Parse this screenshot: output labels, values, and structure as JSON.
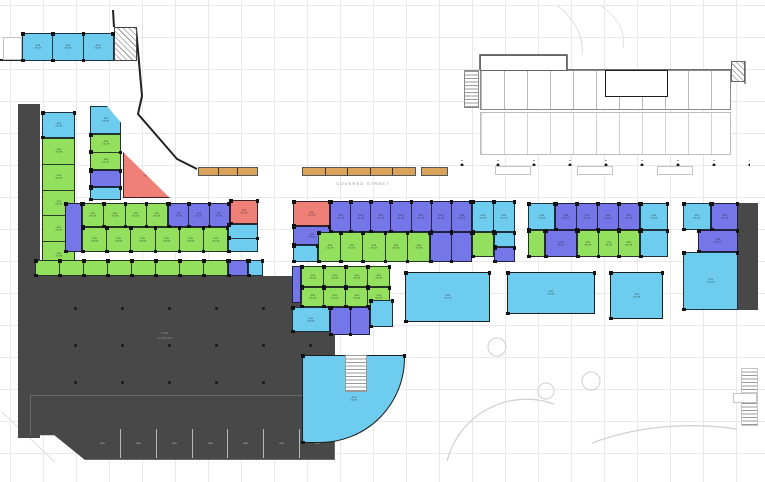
{
  "meta": {
    "width": 765,
    "height": 482,
    "drawing_type": "architectural ground-floor retail/parking plan"
  },
  "palette": {
    "cyan": "#6ecdee",
    "green": "#92e05e",
    "purple": "#7577e8",
    "red": "#ef8077",
    "orange": "#d9a35b",
    "dark": "#484848",
    "wall": "#1c1c1c",
    "faint": "#cfcfcf",
    "grid": "#e9e9e9"
  },
  "labels": {
    "covered_street": "COVERED  STREET",
    "illegible_unit_line1": "xxx",
    "illegible_unit_line2": "xx.xx",
    "parking_line1": "xxx",
    "parking_line2": "x,xxx xx",
    "storage_unit": "xxx",
    "ramp_box": "xxx"
  },
  "floorplan": {
    "rects": [
      {
        "name": "topleft-cyan-row",
        "x": 22,
        "y": 33,
        "w": 92,
        "h": 28,
        "fill": "cyan",
        "cols": 3,
        "label": true
      },
      {
        "name": "topleft-stair-hatch",
        "x": 114,
        "y": 27,
        "w": 23,
        "h": 34,
        "fill": "#ffffff",
        "hatch": "d",
        "stroke": "#444"
      },
      {
        "name": "topleft-small-room",
        "x": 3,
        "y": 37,
        "w": 19,
        "h": 23,
        "fill": "#ffffff",
        "stroke": "#c3c3c3"
      },
      {
        "name": "left-dark-strip",
        "x": 18,
        "y": 104,
        "w": 22,
        "h": 334,
        "fill": "dark"
      },
      {
        "name": "left-colA-cyan",
        "x": 42,
        "y": 112,
        "w": 33,
        "h": 26,
        "fill": "cyan",
        "label": true
      },
      {
        "name": "left-colA-green",
        "x": 42,
        "y": 138,
        "w": 33,
        "h": 130,
        "fill": "green",
        "rows": 5,
        "label": true
      },
      {
        "name": "left-colB-cyan-top",
        "x": 90,
        "y": 106,
        "w": 31,
        "h": 28,
        "fill": "cyan",
        "clip": "polygon(0 0,55% 0,100% 60%,100% 100%,0 100%)",
        "label": true
      },
      {
        "name": "left-colB-green",
        "x": 90,
        "y": 134,
        "w": 31,
        "h": 36,
        "fill": "green",
        "rows": 2,
        "label": true
      },
      {
        "name": "left-colB-purple",
        "x": 90,
        "y": 170,
        "w": 31,
        "h": 17,
        "fill": "purple"
      },
      {
        "name": "left-colB-cyan-bottom",
        "x": 90,
        "y": 187,
        "w": 31,
        "h": 13,
        "fill": "cyan"
      },
      {
        "name": "red-triangle-unit",
        "x": 123,
        "y": 152,
        "w": 47,
        "h": 46,
        "fill": "red",
        "clip": "polygon(0 0,100% 100%,0 100%)",
        "label": true
      },
      {
        "name": "dblrow-purple-end",
        "x": 65,
        "y": 203,
        "w": 17,
        "h": 49,
        "fill": "purple"
      },
      {
        "name": "dblrow-r1-green",
        "x": 82,
        "y": 203,
        "w": 86,
        "h": 24,
        "fill": "green",
        "cols": 4,
        "label": true
      },
      {
        "name": "dblrow-r1-purple",
        "x": 168,
        "y": 203,
        "w": 62,
        "h": 24,
        "fill": "purple",
        "cols": 3,
        "label": true
      },
      {
        "name": "dblrow-r1-red",
        "x": 230,
        "y": 200,
        "w": 28,
        "h": 24,
        "fill": "red",
        "label": true
      },
      {
        "name": "dblrow-r2-green",
        "x": 82,
        "y": 227,
        "w": 146,
        "h": 25,
        "fill": "green",
        "cols": 6,
        "label": true
      },
      {
        "name": "dblrow-r2-cyan",
        "x": 228,
        "y": 224,
        "w": 30,
        "h": 28,
        "fill": "cyan",
        "rows": 2
      },
      {
        "name": "arcade-strip-green",
        "x": 35,
        "y": 260,
        "w": 193,
        "h": 16,
        "fill": "green",
        "cols": 8
      },
      {
        "name": "arcade-strip-purple",
        "x": 228,
        "y": 260,
        "w": 20,
        "h": 16,
        "fill": "purple"
      },
      {
        "name": "arcade-strip-cyan",
        "x": 248,
        "y": 260,
        "w": 15,
        "h": 16,
        "fill": "cyan"
      },
      {
        "name": "parking-garage-main",
        "x": 30,
        "y": 276,
        "w": 305,
        "h": 119,
        "fill": "dark",
        "pattern": "dots",
        "ds": "47px 37px",
        "dc": "rgba(15,15,15,.8)"
      },
      {
        "name": "parking-garage-lower",
        "x": 30,
        "y": 395,
        "w": 305,
        "h": 65,
        "fill": "dark",
        "clip": "polygon(0 0,100% 0,100% 100%,18% 100%,8% 62%,0 62%)",
        "stroke": "#6a6a6a"
      },
      {
        "name": "storage-units-row",
        "x": 85,
        "y": 429,
        "w": 250,
        "h": 29,
        "fill": "none",
        "cols": 7,
        "div": "#b9b9b9",
        "label": "light"
      },
      {
        "name": "center-red-corner",
        "x": 293,
        "y": 201,
        "w": 37,
        "h": 25,
        "fill": "red",
        "label": true
      },
      {
        "name": "center-r1-purple",
        "x": 330,
        "y": 201,
        "w": 142,
        "h": 31,
        "fill": "purple",
        "cols": 7,
        "label": true
      },
      {
        "name": "center-r1-cyan",
        "x": 472,
        "y": 201,
        "w": 43,
        "h": 31,
        "fill": "cyan",
        "cols": 2,
        "label": true
      },
      {
        "name": "center-purple-under-red",
        "x": 293,
        "y": 226,
        "w": 37,
        "h": 19,
        "fill": "purple",
        "label": true
      },
      {
        "name": "center-cyan-small",
        "x": 293,
        "y": 245,
        "w": 25,
        "h": 17,
        "fill": "cyan"
      },
      {
        "name": "center-r2-green",
        "x": 318,
        "y": 232,
        "w": 112,
        "h": 30,
        "fill": "green",
        "cols": 5,
        "label": true
      },
      {
        "name": "center-r2-purple",
        "x": 430,
        "y": 232,
        "w": 42,
        "h": 30,
        "fill": "purple",
        "cols": 2
      },
      {
        "name": "center-r2-green-end",
        "x": 472,
        "y": 232,
        "w": 22,
        "h": 25,
        "fill": "green"
      },
      {
        "name": "center-r2-cyan-end",
        "x": 494,
        "y": 232,
        "w": 21,
        "h": 15,
        "fill": "cyan"
      },
      {
        "name": "center-r2-purple-end",
        "x": 494,
        "y": 247,
        "w": 21,
        "h": 15,
        "fill": "purple"
      },
      {
        "name": "south-purple-sliver",
        "x": 292,
        "y": 266,
        "w": 9,
        "h": 37,
        "fill": "purple"
      },
      {
        "name": "south-green-r1",
        "x": 301,
        "y": 266,
        "w": 89,
        "h": 21,
        "fill": "green",
        "cols": 4,
        "label": true
      },
      {
        "name": "south-green-r2",
        "x": 301,
        "y": 287,
        "w": 89,
        "h": 20,
        "fill": "green",
        "cols": 4,
        "label": true
      },
      {
        "name": "south-cyan",
        "x": 292,
        "y": 307,
        "w": 38,
        "h": 25,
        "fill": "cyan",
        "label": true
      },
      {
        "name": "south-purple",
        "x": 330,
        "y": 307,
        "w": 40,
        "h": 28,
        "fill": "purple",
        "cols": 2
      },
      {
        "name": "south-cyan2",
        "x": 370,
        "y": 300,
        "w": 23,
        "h": 27,
        "fill": "cyan"
      },
      {
        "name": "hall-west",
        "x": 405,
        "y": 272,
        "w": 85,
        "h": 50,
        "fill": "cyan",
        "label": true,
        "wall": true
      },
      {
        "name": "hall-mid",
        "x": 507,
        "y": 272,
        "w": 88,
        "h": 42,
        "fill": "cyan",
        "label": true,
        "wall": true
      },
      {
        "name": "hall-east",
        "x": 610,
        "y": 272,
        "w": 53,
        "h": 47,
        "fill": "cyan",
        "label": true,
        "wall": true
      },
      {
        "name": "curved-corner-unit",
        "x": 302,
        "y": 355,
        "w": 103,
        "h": 88,
        "fill": "cyan",
        "wall": true,
        "round": "0 0 85px 0",
        "label": true
      },
      {
        "name": "curved-unit-stair-notch",
        "x": 345,
        "y": 355,
        "w": 22,
        "h": 37,
        "fill": "#ffffff",
        "stroke": "#999",
        "hatch": "h"
      },
      {
        "name": "right-r1-cyan",
        "x": 528,
        "y": 203,
        "w": 27,
        "h": 27,
        "fill": "cyan",
        "label": true
      },
      {
        "name": "right-r1-purple",
        "x": 555,
        "y": 203,
        "w": 85,
        "h": 27,
        "fill": "purple",
        "cols": 4,
        "label": true
      },
      {
        "name": "right-r1-cyan2",
        "x": 640,
        "y": 203,
        "w": 28,
        "h": 27,
        "fill": "cyan",
        "label": true
      },
      {
        "name": "right-r2-green",
        "x": 528,
        "y": 230,
        "w": 17,
        "h": 27,
        "fill": "green"
      },
      {
        "name": "right-r2-purple",
        "x": 545,
        "y": 230,
        "w": 32,
        "h": 27,
        "fill": "purple",
        "label": true
      },
      {
        "name": "right-r2-green2",
        "x": 577,
        "y": 230,
        "w": 63,
        "h": 27,
        "fill": "green",
        "cols": 3,
        "label": true
      },
      {
        "name": "right-r2-cyan",
        "x": 640,
        "y": 230,
        "w": 28,
        "h": 27,
        "fill": "cyan"
      },
      {
        "name": "farright-cyan",
        "x": 683,
        "y": 203,
        "w": 28,
        "h": 27,
        "fill": "cyan",
        "label": true
      },
      {
        "name": "farright-purple",
        "x": 711,
        "y": 203,
        "w": 27,
        "h": 27,
        "fill": "purple",
        "label": true
      },
      {
        "name": "farright-purple2",
        "x": 698,
        "y": 230,
        "w": 40,
        "h": 22,
        "fill": "purple",
        "label": true
      },
      {
        "name": "farright-big-cyan",
        "x": 683,
        "y": 252,
        "w": 55,
        "h": 58,
        "fill": "cyan",
        "label": true
      },
      {
        "name": "farright-dark-strip",
        "x": 738,
        "y": 203,
        "w": 20,
        "h": 107,
        "fill": "dark"
      },
      {
        "name": "northeast-rooms-band1",
        "x": 480,
        "y": 70,
        "w": 251,
        "h": 40,
        "fill": "#ffffff",
        "stroke": "#8a8a8a",
        "pattern": "v",
        "vs": 23,
        "vc": "#b9b9b9"
      },
      {
        "name": "northeast-rooms-band2",
        "x": 480,
        "y": 112,
        "w": 251,
        "h": 43,
        "fill": "#ffffff",
        "stroke": "#bdbdbd",
        "pattern": "v",
        "vs": 23,
        "vc": "#d2d2d2"
      },
      {
        "name": "northeast-top-box",
        "x": 480,
        "y": 55,
        "w": 87,
        "h": 16,
        "fill": "#ffffff",
        "stroke": "#666"
      },
      {
        "name": "northeast-elevator-core",
        "x": 605,
        "y": 70,
        "w": 63,
        "h": 27,
        "fill": "#ffffff",
        "wall": true
      },
      {
        "name": "northeast-stair",
        "x": 464,
        "y": 70,
        "w": 15,
        "h": 38,
        "fill": "#ffffff",
        "hatch": "h",
        "stroke": "#8a8a8a"
      },
      {
        "name": "northeast-hatch-box",
        "x": 731,
        "y": 61,
        "w": 14,
        "h": 21,
        "fill": "#ffffff",
        "hatch": "d",
        "stroke": "#666"
      },
      {
        "name": "northeast-dot-row",
        "x": 458,
        "y": 160,
        "w": 292,
        "h": 6,
        "fill": "none",
        "pattern": "dots",
        "ds": "36px 6px",
        "dc": "#222"
      },
      {
        "name": "northeast-sign1",
        "x": 495,
        "y": 166,
        "w": 36,
        "h": 9,
        "fill": "#ffffff",
        "stroke": "#c3c3c3",
        "label": "light"
      },
      {
        "name": "northeast-sign2",
        "x": 577,
        "y": 166,
        "w": 36,
        "h": 9,
        "fill": "#ffffff",
        "stroke": "#c3c3c3",
        "label": "light"
      },
      {
        "name": "northeast-sign3",
        "x": 657,
        "y": 166,
        "w": 36,
        "h": 9,
        "fill": "#ffffff",
        "stroke": "#c3c3c3",
        "label": "light"
      },
      {
        "name": "awning-strip-1",
        "x": 198,
        "y": 167,
        "w": 60,
        "h": 9,
        "fill": "orange",
        "cols": 3,
        "stroke": "#555"
      },
      {
        "name": "awning-strip-2",
        "x": 302,
        "y": 167,
        "w": 114,
        "h": 9,
        "fill": "orange",
        "cols": 5,
        "stroke": "#555"
      },
      {
        "name": "awning-strip-3",
        "x": 421,
        "y": 167,
        "w": 27,
        "h": 9,
        "fill": "orange",
        "stroke": "#555"
      },
      {
        "name": "ramp-hatch-strip",
        "x": 741,
        "y": 368,
        "w": 17,
        "h": 58,
        "fill": "#ffffff",
        "hatch": "h",
        "stroke": "#c3c3c3"
      },
      {
        "name": "ramp-box",
        "x": 733,
        "y": 393,
        "w": 24,
        "h": 10,
        "fill": "#ffffff",
        "stroke": "#c3c3c3",
        "label": "light"
      }
    ],
    "paths": [
      {
        "name": "site-boundary-top",
        "d": "M113 10 L114 27",
        "w": 2,
        "c": "#222"
      },
      {
        "name": "site-boundary-diagonal",
        "d": "M136 28 L142 96 L138 114 L177 159 L197 169",
        "w": 2,
        "c": "#222"
      },
      {
        "name": "topleft-wall",
        "d": "M0 60 L76 60",
        "w": 2,
        "c": "#222"
      },
      {
        "name": "northeast-boundary",
        "d": "M480 70 L480 55 L567 55 L567 70 L745 70",
        "w": 1.4,
        "c": "#444"
      },
      {
        "name": "northeast-boundary-right",
        "d": "M745 61 L745 84",
        "w": 1.2,
        "c": "#555"
      },
      {
        "name": "elevator-x1",
        "d": "M606 71 L635 96 M635 71 L606 96",
        "w": 0.8,
        "c": "#888"
      },
      {
        "name": "elevator-x2",
        "d": "M637 71 L667 96 M667 71 L637 96",
        "w": 0.8,
        "c": "#888"
      },
      {
        "name": "landscape-arc-big",
        "d": "M447 461 A82 82 0 0 1 554 404",
        "w": 1.2,
        "c": "#cfcfcf"
      },
      {
        "name": "landscape-arc-road",
        "d": "M592 443 Q660 418 737 429",
        "w": 1.2,
        "c": "#cfcfcf"
      },
      {
        "name": "road-curve-topright",
        "d": "M557 5 Q585 28 582 55",
        "w": 1,
        "c": "#dddddd"
      },
      {
        "name": "road-curve-topright2",
        "d": "M600 5 Q627 24 623 48",
        "w": 1,
        "c": "#e2e2e2"
      },
      {
        "name": "road-edge-bottomleft",
        "d": "M2 412 L55 462",
        "w": 1,
        "c": "#dddddd"
      }
    ],
    "circles": [
      {
        "name": "tree-circle-1",
        "cx": 497,
        "cy": 347,
        "r": 9
      },
      {
        "name": "tree-circle-2",
        "cx": 546,
        "cy": 391,
        "r": 8
      },
      {
        "name": "tree-circle-3",
        "cx": 591,
        "cy": 381,
        "r": 9
      }
    ],
    "texts": [
      {
        "name": "covered-street-label",
        "x": 308,
        "y": 181,
        "w": 110,
        "bind": "covered_street",
        "size": 4,
        "color": "#8a8a8a",
        "ls": 1.2
      },
      {
        "name": "parking-label-line1",
        "x": 135,
        "y": 330,
        "w": 60,
        "bind": "parking_line1",
        "size": 4,
        "color": "#9a9a9a",
        "ls": 0.5
      },
      {
        "name": "parking-label-line2",
        "x": 135,
        "y": 336,
        "w": 60,
        "bind": "parking_line2",
        "size": 3.5,
        "color": "#9a9a9a",
        "ls": 0.3
      }
    ]
  }
}
